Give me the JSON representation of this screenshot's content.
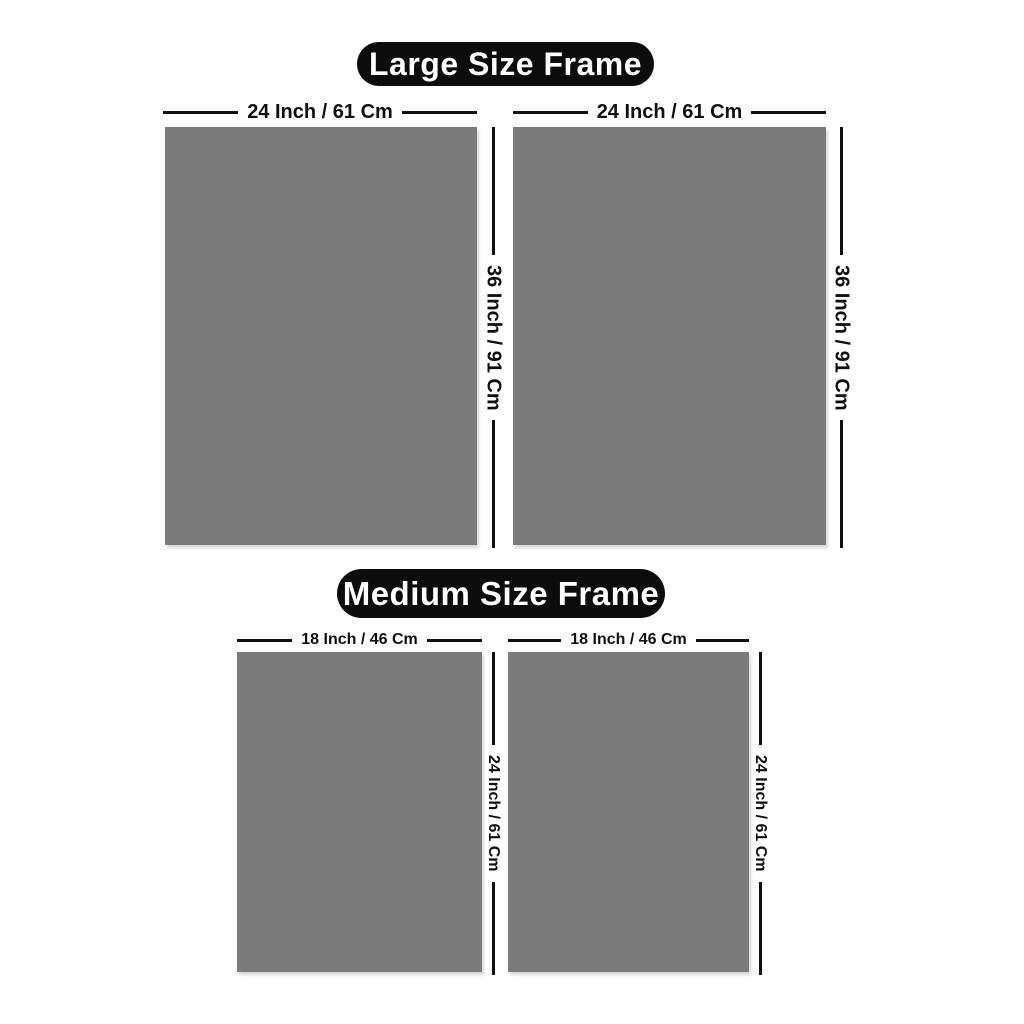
{
  "colors": {
    "background": "#ffffff",
    "frame_fill": "#7b7b7b",
    "badge_background": "#0c0c0c",
    "badge_text_color": "#ffffff",
    "dimension_color": "#0f0f0f"
  },
  "sections": {
    "large": {
      "title": "Large Size Frame",
      "frame_count": 2,
      "width_label": "24 Inch / 61 Cm",
      "height_label": "36 Inch / 91 Cm"
    },
    "medium": {
      "title": "Medium Size Frame",
      "frame_count": 2,
      "width_label": "18 Inch / 46 Cm",
      "height_label": "24 Inch / 61 Cm"
    }
  }
}
